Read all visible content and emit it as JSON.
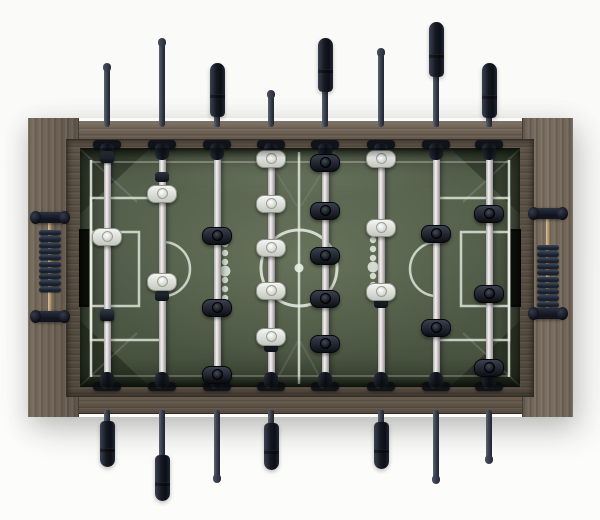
{
  "scene": {
    "description": "Top-down product photo of a foosball (table soccer) table with wood frame, green printed pitch, 8 telescopic rods with black grips, white vs black player figures and abacus score counters on both end panels",
    "background_color": "#fbfbf9"
  },
  "colors": {
    "wood_base": "#6d6254",
    "wood_dark": "#4f463c",
    "wood_light": "#837667",
    "field_base": "#4e5946",
    "field_light": "#75816a",
    "field_corner_dark": "#141a0e",
    "line": "#e9efe5",
    "rod_silver_hi": "#f4f1ef",
    "rod_silver_lo": "#8e8c94",
    "rod_dark_steel": "#343b47",
    "grip_black": "#14171f",
    "player_white": "#eceded",
    "player_black": "#15181e",
    "goal_slot": "#0b0e09",
    "bead_dark": "#18202d",
    "bead_hi": "#39475c",
    "counter_rod_brass": "#b49a73"
  },
  "layout": {
    "width": 600,
    "height": 520,
    "frame": {
      "outer_x": 28,
      "outer_y": 118,
      "outer_w": 544,
      "outer_h": 299,
      "panel_w": 50,
      "rail_top_y": 121,
      "rail_bot_y": 387,
      "rail_h": 27,
      "lip": {
        "x": 66,
        "y": 139,
        "w": 468,
        "h": 258
      }
    },
    "field": {
      "x": 80,
      "y": 148,
      "w": 440,
      "h": 239
    },
    "goals": {
      "y": 229,
      "h": 78,
      "w": 13,
      "left_x": 79,
      "right_x": 508
    },
    "rod": {
      "field_w": 7,
      "outer_w": 6,
      "grip_w": 15,
      "field_top": 150,
      "field_bottom": 382
    },
    "bushing": {
      "bar_w": 28,
      "bar_h": 9,
      "blob_w": 14,
      "blob_h": 17,
      "top_bar_y": 140,
      "top_blob_y": 143,
      "bot_bar_y": 382,
      "bot_blob_y": 372
    }
  },
  "field_markings": [
    {
      "name": "corner-shade-tl",
      "type": "poly",
      "pts": "80,148 150,148 80,214",
      "fill": "rgba(18,24,14,0.40)"
    },
    {
      "name": "corner-shade-tr",
      "type": "poly",
      "pts": "520,148 450,148 520,214",
      "fill": "rgba(18,24,14,0.40)"
    },
    {
      "name": "corner-shade-bl",
      "type": "poly",
      "pts": "80,387 80,321 150,387",
      "fill": "rgba(18,24,14,0.44)"
    },
    {
      "name": "corner-shade-br",
      "type": "poly",
      "pts": "520,387 520,321 450,387",
      "fill": "rgba(18,24,14,0.44)"
    },
    {
      "name": "corner-seam-tl",
      "type": "line",
      "x1": 80,
      "y1": 149,
      "x2": 137,
      "y2": 202,
      "o": 0.14,
      "sw": 2
    },
    {
      "name": "corner-seam-tr",
      "type": "line",
      "x1": 520,
      "y1": 149,
      "x2": 463,
      "y2": 202,
      "o": 0.14,
      "sw": 2
    },
    {
      "name": "corner-seam-bl",
      "type": "line",
      "x1": 80,
      "y1": 386,
      "x2": 137,
      "y2": 333,
      "o": 0.14,
      "sw": 2
    },
    {
      "name": "corner-seam-br",
      "type": "line",
      "x1": 520,
      "y1": 386,
      "x2": 463,
      "y2": 333,
      "o": 0.14,
      "sw": 2
    },
    {
      "name": "center-wedge-top-l",
      "type": "line",
      "x1": 262,
      "y1": 150,
      "x2": 297,
      "y2": 206,
      "o": 0.09,
      "sw": 2
    },
    {
      "name": "center-wedge-top-r",
      "type": "line",
      "x1": 336,
      "y1": 150,
      "x2": 301,
      "y2": 206,
      "o": 0.09,
      "sw": 2
    },
    {
      "name": "center-wedge-bot-l",
      "type": "line",
      "x1": 274,
      "y1": 385,
      "x2": 298,
      "y2": 341,
      "o": 0.1,
      "sw": 2
    },
    {
      "name": "center-wedge-bot-r",
      "type": "line",
      "x1": 324,
      "y1": 385,
      "x2": 300,
      "y2": 341,
      "o": 0.1,
      "sw": 2
    },
    {
      "name": "touchline-top",
      "type": "line",
      "x1": 91,
      "y1": 162,
      "x2": 509,
      "y2": 162,
      "o": 0.3,
      "sw": 2
    },
    {
      "name": "touchline-bottom",
      "type": "line",
      "x1": 91,
      "y1": 376,
      "x2": 509,
      "y2": 376,
      "o": 0.26,
      "sw": 2
    },
    {
      "name": "goal-line-left",
      "type": "line",
      "x1": 91,
      "y1": 160,
      "x2": 91,
      "y2": 377,
      "o": 0.85,
      "sw": 2.5
    },
    {
      "name": "goal-line-right",
      "type": "line",
      "x1": 509,
      "y1": 160,
      "x2": 509,
      "y2": 377,
      "o": 0.85,
      "sw": 2.5
    },
    {
      "name": "penalty-box-left",
      "type": "rect",
      "x": 91,
      "y": 198,
      "w": 72,
      "h": 142,
      "o": 0.78,
      "sw": 2.5
    },
    {
      "name": "goal-box-left",
      "type": "rect",
      "x": 91,
      "y": 232,
      "w": 48,
      "h": 74,
      "o": 0.78,
      "sw": 2.5
    },
    {
      "name": "penalty-arc-left",
      "type": "path",
      "d": "M163,242 A27,27 0 0 1 163,296",
      "o": 0.78,
      "sw": 2.5
    },
    {
      "name": "penalty-box-right",
      "type": "rect",
      "x": 437,
      "y": 198,
      "w": 72,
      "h": 142,
      "o": 0.78,
      "sw": 2.5
    },
    {
      "name": "goal-box-right",
      "type": "rect",
      "x": 461,
      "y": 232,
      "w": 48,
      "h": 74,
      "o": 0.78,
      "sw": 2.5
    },
    {
      "name": "penalty-arc-right",
      "type": "path",
      "d": "M437,242 A27,27 0 0 0 437,296",
      "o": 0.78,
      "sw": 2.5
    },
    {
      "name": "center-line",
      "type": "line",
      "x1": 299,
      "y1": 152,
      "x2": 299,
      "y2": 384,
      "o": 0.8,
      "sw": 2.5
    },
    {
      "name": "center-circle",
      "type": "circle",
      "cx": 299,
      "cy": 268,
      "r": 38,
      "o": 0.85,
      "sw": 3
    },
    {
      "name": "center-spot",
      "type": "dot",
      "cx": 299,
      "cy": 268,
      "r": 4.5,
      "o": 0.9
    },
    {
      "name": "dot-column-left",
      "type": "dots",
      "x": 225,
      "ys": [
        244,
        253,
        262,
        271,
        280,
        289,
        298
      ],
      "r": 3.2,
      "big_index": 3,
      "big_r": 5.4,
      "o": 0.85
    },
    {
      "name": "dot-column-right",
      "type": "dots",
      "x": 373,
      "ys": [
        240,
        249,
        258,
        267,
        276,
        285,
        294
      ],
      "r": 3.2,
      "big_index": 3,
      "big_r": 5.4,
      "o": 0.85
    }
  ],
  "rods": [
    {
      "id": 1,
      "x": 107,
      "team": "white",
      "top": {
        "kind": "tip",
        "end": 67
      },
      "bottom": {
        "kind": "handle",
        "grip_start": 421,
        "grip_end": 467
      },
      "players": [
        {
          "t": "bumper",
          "y": 157
        },
        {
          "t": "white",
          "y": 236
        },
        {
          "t": "bumper",
          "y": 315
        }
      ],
      "stoppers": []
    },
    {
      "id": 2,
      "x": 162,
      "team": "white",
      "top": {
        "kind": "tip",
        "end": 42
      },
      "bottom": {
        "kind": "handle",
        "grip_start": 455,
        "grip_end": 501
      },
      "players": [
        {
          "t": "white",
          "y": 193
        },
        {
          "t": "white",
          "y": 281
        }
      ],
      "stoppers": [
        177,
        296
      ]
    },
    {
      "id": 3,
      "x": 217,
      "team": "black",
      "top": {
        "kind": "handle",
        "grip_start": 63,
        "grip_end": 117
      },
      "bottom": {
        "kind": "tip",
        "end": 478
      },
      "players": [
        {
          "t": "black",
          "y": 235
        },
        {
          "t": "black",
          "y": 307
        },
        {
          "t": "black",
          "y": 374
        }
      ],
      "stoppers": []
    },
    {
      "id": 4,
      "x": 271,
      "team": "white",
      "top": {
        "kind": "tip",
        "end": 94
      },
      "bottom": {
        "kind": "handle",
        "grip_start": 423,
        "grip_end": 470
      },
      "players": [
        {
          "t": "white",
          "y": 158
        },
        {
          "t": "white",
          "y": 203
        },
        {
          "t": "white",
          "y": 247
        },
        {
          "t": "white",
          "y": 290
        },
        {
          "t": "white",
          "y": 336
        }
      ],
      "stoppers": [
        347
      ]
    },
    {
      "id": 5,
      "x": 325,
      "team": "black",
      "top": {
        "kind": "handle",
        "grip_start": 38,
        "grip_end": 92
      },
      "bottom": {
        "kind": "none"
      },
      "players": [
        {
          "t": "black",
          "y": 162
        },
        {
          "t": "black",
          "y": 210
        },
        {
          "t": "black",
          "y": 255
        },
        {
          "t": "black",
          "y": 298
        },
        {
          "t": "black",
          "y": 343
        }
      ],
      "stoppers": []
    },
    {
      "id": 6,
      "x": 381,
      "team": "white",
      "top": {
        "kind": "tip",
        "end": 52
      },
      "bottom": {
        "kind": "handle",
        "grip_start": 422,
        "grip_end": 469
      },
      "players": [
        {
          "t": "white",
          "y": 158
        },
        {
          "t": "white",
          "y": 227
        },
        {
          "t": "white",
          "y": 291
        }
      ],
      "stoppers": [
        303
      ]
    },
    {
      "id": 7,
      "x": 436,
      "team": "black",
      "top": {
        "kind": "handle",
        "grip_start": 22,
        "grip_end": 77
      },
      "bottom": {
        "kind": "tip",
        "end": 479
      },
      "players": [
        {
          "t": "black",
          "y": 233
        },
        {
          "t": "black",
          "y": 327
        }
      ],
      "stoppers": []
    },
    {
      "id": 8,
      "x": 489,
      "team": "black",
      "top": {
        "kind": "handle",
        "grip_start": 63,
        "grip_end": 118
      },
      "bottom": {
        "kind": "tip",
        "end": 459
      },
      "players": [
        {
          "t": "black",
          "y": 213
        },
        {
          "t": "black",
          "y": 293
        },
        {
          "t": "black",
          "y": 367
        }
      ],
      "stoppers": []
    }
  ],
  "counters": [
    {
      "side": "left",
      "cx": 50,
      "cap1_y": 212,
      "cap2_y": 311,
      "bead_n": 10,
      "bead_start": 230,
      "bead_h": 6.3
    },
    {
      "side": "right",
      "cx": 548,
      "cap1_y": 208,
      "cap2_y": 308,
      "bead_n": 10,
      "bead_start": 245,
      "bead_h": 6.3
    }
  ]
}
